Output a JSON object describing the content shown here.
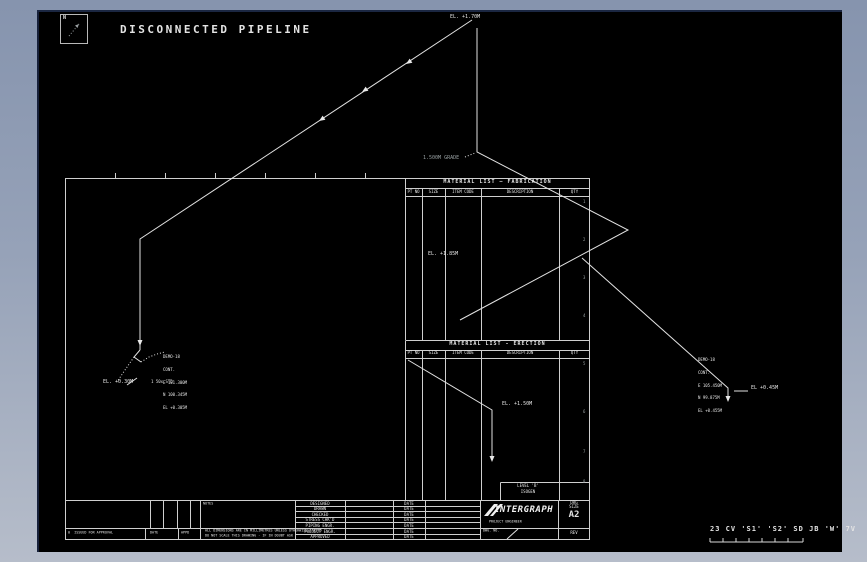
{
  "drawing": {
    "title": "DISCONNECTED PIPELINE",
    "north_label": "N"
  },
  "labels": {
    "el_top": "EL. +1.70M",
    "grade": "1.500M GRADE",
    "el_mid": "EL. +1.85M",
    "el_erection": "EL. +1.50M",
    "left_cluster": [
      "DEMO-18",
      "CONT.",
      "E 101.300M",
      "N 100.345M",
      "EL +0.305M"
    ],
    "left_el": "EL. +0.30M",
    "left_leader": "1 50x STD",
    "right_cluster": [
      "DEMO-18",
      "CONT.",
      "E 105.450M",
      "N 99.875M",
      "EL +0.455M"
    ],
    "right_leader": "EL +0.45M"
  },
  "fabrication_table": {
    "title": "MATERIAL LIST — FABRICATION",
    "columns": [
      "PT NO",
      "SIZE",
      "ITEM CODE",
      "DESCRIPTION",
      "QTY"
    ]
  },
  "erection_table": {
    "title": "MATERIAL LIST - ERECTION",
    "columns": [
      "PT NO",
      "SIZE",
      "ITEM CODE",
      "DESCRIPTION",
      "QTY"
    ]
  },
  "zone_digits": [
    "1",
    "2",
    "3",
    "4",
    "5",
    "6",
    "7",
    "8"
  ],
  "titleblock": {
    "notes_label": "NOTES",
    "notes_line1": "ALL DIMENSIONS ARE IN MILLIMETRES UNLESS OTHERWISE STATED",
    "notes_line2": "DO NOT SCALE THIS DRAWING - IF IN DOUBT ASK",
    "rev_row": {
      "description": "0  ISSUED FOR APPROVAL",
      "date": "DATE",
      "appd": "APPD"
    },
    "fields": [
      {
        "left": "DESIGNED",
        "right": "DATE"
      },
      {
        "left": "DRAWN",
        "right": "DATE"
      },
      {
        "left": "CHECKED",
        "right": "DATE"
      },
      {
        "left": "STRESS CHK'D",
        "right": "DATE"
      },
      {
        "left": "PIPING ENGR.",
        "right": "DATE"
      },
      {
        "left": "PROJECT ENGR.",
        "right": "DATE"
      },
      {
        "left": "APPROVED",
        "right": "DATE"
      }
    ],
    "level_line1": "LEVEL 'B'",
    "level_line2": "ISOGEN",
    "logo_text": "INTERGRAPH",
    "logo_sub": "PROJECT ENGINEER",
    "size_label1": "DRG",
    "size_label2": "SIZE",
    "size_value": "A2",
    "dwg_no_label": "DWG. NO.",
    "rev_label": "REV"
  },
  "stamps": {
    "plot_stamp": "23 CV 'S1' 'S2' SD JB 'W' 7V"
  }
}
